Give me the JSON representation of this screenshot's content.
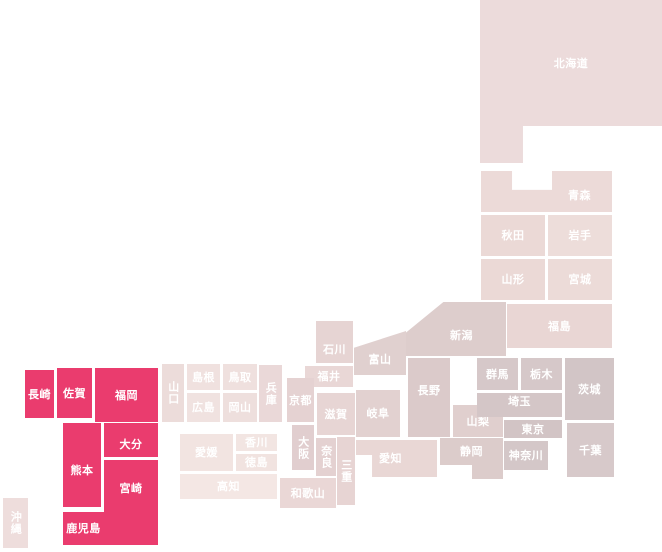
{
  "page": {
    "background": "#ffffff",
    "description_label": ""
  },
  "chart_data": {
    "type": "heatmap",
    "subtype": "japan-prefecture-tile-map",
    "title": "",
    "legend": null,
    "grid": false,
    "highlight_color": "#ea3c6e",
    "label_color": "#ffffff",
    "highlighted_prefectures": [
      "長崎",
      "佐賀",
      "福岡",
      "熊本",
      "大分",
      "宮崎",
      "鹿児島"
    ],
    "prefectures": [
      {
        "id": "hokkaido",
        "name": "北海道",
        "value": 0,
        "x": 480,
        "y": 0,
        "w": 182,
        "h": 163,
        "color": "#ecdbdb",
        "clip": "polygon(0% 0%, 100% 0%, 100% 77.3%, 23.6% 77.3%, 23.6% 100%, 0% 100%)",
        "dy": -18
      },
      {
        "id": "aomori",
        "name": "青森",
        "value": 0,
        "x": 481,
        "y": 171,
        "w": 131,
        "h": 41,
        "color": "#ecdad8",
        "clip": "polygon(0% 0%, 23.7% 0%, 23.7% 46%, 54.2% 46%, 54.2% 0%, 100% 0%, 100% 100%, 0% 100%)",
        "dx": 33,
        "dy": 4
      },
      {
        "id": "akita",
        "name": "秋田",
        "value": 0,
        "x": 481,
        "y": 215,
        "w": 64,
        "h": 41,
        "color": "#ebd9d6"
      },
      {
        "id": "iwate",
        "name": "岩手",
        "value": 0,
        "x": 548,
        "y": 215,
        "w": 64,
        "h": 41,
        "color": "#edddda"
      },
      {
        "id": "yamagata",
        "name": "山形",
        "value": 0,
        "x": 481,
        "y": 259,
        "w": 64,
        "h": 41,
        "color": "#ebd9d6"
      },
      {
        "id": "miyagi",
        "name": "宮城",
        "value": 0,
        "x": 548,
        "y": 259,
        "w": 64,
        "h": 41,
        "color": "#ecdbd8"
      },
      {
        "id": "fukushima",
        "name": "福島",
        "value": 0,
        "x": 507,
        "y": 304,
        "w": 105,
        "h": 44,
        "color": "#e9d6d4"
      },
      {
        "id": "niigata",
        "name": "新潟",
        "value": 0,
        "x": 405,
        "y": 302,
        "w": 101,
        "h": 54,
        "color": "#ddcdcc",
        "clip": "polygon(0% 58%, 38% 0%, 100% 0%, 100% 100%, 0% 100%)",
        "dx": 6,
        "dy": 6
      },
      {
        "id": "toyama",
        "name": "富山",
        "value": 0,
        "x": 354,
        "y": 331,
        "w": 52,
        "h": 44,
        "color": "#e0d0cf",
        "clip": "polygon(0% 38%, 100% 0%, 100% 100%, 0% 100%)",
        "dy": 6
      },
      {
        "id": "ishikawa",
        "name": "石川",
        "value": 0,
        "x": 316,
        "y": 321,
        "w": 37,
        "h": 42,
        "color": "#e6d4d3",
        "dy": 7
      },
      {
        "id": "fukui",
        "name": "福井",
        "value": 0,
        "x": 305,
        "y": 366,
        "w": 48,
        "h": 21,
        "color": "#e9d7d6"
      },
      {
        "id": "nagano",
        "name": "長野",
        "value": 0,
        "x": 408,
        "y": 358,
        "w": 42,
        "h": 79,
        "color": "#dbcaca",
        "dy": -7
      },
      {
        "id": "yamanashi",
        "name": "山梨",
        "value": 0,
        "x": 453,
        "y": 405,
        "w": 50,
        "h": 32,
        "color": "#e0cfce"
      },
      {
        "id": "gifu",
        "name": "岐阜",
        "value": 0,
        "x": 356,
        "y": 390,
        "w": 44,
        "h": 47,
        "color": "#e2d1d0"
      },
      {
        "id": "shizuoka",
        "name": "静岡",
        "value": 0,
        "x": 440,
        "y": 438,
        "w": 63,
        "h": 41,
        "color": "#dccccb",
        "clip": "polygon(0% 0%, 100% 0%, 100% 100%, 50.8% 100%, 50.8% 65.9%, 0% 65.9%)",
        "dy": -7
      },
      {
        "id": "aichi",
        "name": "愛知",
        "value": 0,
        "x": 356,
        "y": 440,
        "w": 81,
        "h": 37,
        "color": "#e9d7d5",
        "clip": "polygon(0% 0%, 100% 0%, 100% 100%, 19.8% 100%, 19.8% 40.5%, 0% 40.5%)",
        "dx": -6
      },
      {
        "id": "gunma",
        "name": "群馬",
        "value": 0,
        "x": 477,
        "y": 358,
        "w": 41,
        "h": 32,
        "color": "#d6c8c9"
      },
      {
        "id": "tochigi",
        "name": "栃木",
        "value": 0,
        "x": 521,
        "y": 358,
        "w": 41,
        "h": 32,
        "color": "#d6c8c9"
      },
      {
        "id": "ibaraki",
        "name": "茨城",
        "value": 0,
        "x": 565,
        "y": 358,
        "w": 49,
        "h": 62,
        "color": "#d2c5c6"
      },
      {
        "id": "saitama",
        "name": "埼玉",
        "value": 0,
        "x": 477,
        "y": 393,
        "w": 85,
        "h": 24,
        "color": "#d4c6c7",
        "dy": -4
      },
      {
        "id": "tokyo",
        "name": "東京",
        "value": 0,
        "x": 504,
        "y": 420,
        "w": 58,
        "h": 18,
        "color": "#d2c4c5"
      },
      {
        "id": "kanagawa",
        "name": "神奈川",
        "value": 0,
        "x": 504,
        "y": 441,
        "w": 44,
        "h": 29,
        "color": "#d4c7c8"
      },
      {
        "id": "chiba",
        "name": "千葉",
        "value": 0,
        "x": 567,
        "y": 423,
        "w": 47,
        "h": 54,
        "color": "#d7c9ca"
      },
      {
        "id": "shiga",
        "name": "滋賀",
        "value": 0,
        "x": 317,
        "y": 393,
        "w": 38,
        "h": 42,
        "color": "#e7d5d4"
      },
      {
        "id": "kyoto",
        "name": "京都",
        "value": 0,
        "x": 287,
        "y": 378,
        "w": 27,
        "h": 44,
        "color": "#e5d2d2"
      },
      {
        "id": "osaka",
        "name": "大阪",
        "value": 0,
        "x": 292,
        "y": 425,
        "w": 22,
        "h": 45,
        "color": "#e1cecf",
        "dir": "v"
      },
      {
        "id": "nara",
        "name": "奈良",
        "value": 0,
        "x": 316,
        "y": 438,
        "w": 20,
        "h": 38,
        "color": "#e4d1d1",
        "dir": "v"
      },
      {
        "id": "mie",
        "name": "三重",
        "value": 0,
        "x": 337,
        "y": 437,
        "w": 18,
        "h": 68,
        "color": "#e7d4d3",
        "dir": "v"
      },
      {
        "id": "wakayama",
        "name": "和歌山",
        "value": 0,
        "x": 280,
        "y": 478,
        "w": 56,
        "h": 30,
        "color": "#ead7d6"
      },
      {
        "id": "hyogo",
        "name": "兵庫",
        "value": 0,
        "x": 259,
        "y": 365,
        "w": 23,
        "h": 57,
        "color": "#ead8d8",
        "dir": "v"
      },
      {
        "id": "tottori",
        "name": "鳥取",
        "value": 0,
        "x": 223,
        "y": 364,
        "w": 34,
        "h": 26,
        "color": "#efe0de"
      },
      {
        "id": "shimane",
        "name": "島根",
        "value": 0,
        "x": 187,
        "y": 364,
        "w": 33,
        "h": 26,
        "color": "#f0e1df"
      },
      {
        "id": "okayama",
        "name": "岡山",
        "value": 0,
        "x": 223,
        "y": 393,
        "w": 34,
        "h": 29,
        "color": "#eedfdd"
      },
      {
        "id": "hiroshima",
        "name": "広島",
        "value": 0,
        "x": 187,
        "y": 393,
        "w": 33,
        "h": 29,
        "color": "#f0e2e0"
      },
      {
        "id": "yamaguchi",
        "name": "山口",
        "value": 0,
        "x": 162,
        "y": 364,
        "w": 22,
        "h": 58,
        "color": "#ecdcda",
        "dir": "v"
      },
      {
        "id": "kagawa",
        "name": "香川",
        "value": 0,
        "x": 236,
        "y": 434,
        "w": 41,
        "h": 17,
        "color": "#f2e5e2"
      },
      {
        "id": "ehime",
        "name": "愛媛",
        "value": 0,
        "x": 180,
        "y": 434,
        "w": 53,
        "h": 37,
        "color": "#f2e4e1"
      },
      {
        "id": "tokushima",
        "name": "徳島",
        "value": 0,
        "x": 236,
        "y": 454,
        "w": 41,
        "h": 17,
        "color": "#f1e3e0"
      },
      {
        "id": "kochi",
        "name": "高知",
        "value": 0,
        "x": 180,
        "y": 474,
        "w": 97,
        "h": 25,
        "color": "#f4e7e4"
      },
      {
        "id": "fukuoka",
        "name": "福岡",
        "value": 1,
        "x": 95,
        "y": 368,
        "w": 63,
        "h": 54,
        "color": "#ea3c6e"
      },
      {
        "id": "saga",
        "name": "佐賀",
        "value": 1,
        "x": 57,
        "y": 368,
        "w": 35,
        "h": 50,
        "color": "#ea3c6e"
      },
      {
        "id": "nagasaki",
        "name": "長崎",
        "value": 1,
        "x": 25,
        "y": 370,
        "w": 29,
        "h": 48,
        "color": "#ea3c6e"
      },
      {
        "id": "kumamoto",
        "name": "熊本",
        "value": 1,
        "x": 63,
        "y": 423,
        "w": 38,
        "h": 84,
        "color": "#ea3c6e",
        "dy": 5
      },
      {
        "id": "oita",
        "name": "大分",
        "value": 1,
        "x": 104,
        "y": 423,
        "w": 54,
        "h": 34,
        "color": "#ea3c6e",
        "dy": 4
      },
      {
        "id": "miyazaki",
        "name": "宮崎",
        "value": 1,
        "x": 104,
        "y": 460,
        "w": 54,
        "h": 57,
        "color": "#ea3c6e"
      },
      {
        "id": "kagoshima",
        "name": "鹿児島",
        "value": 1,
        "x": 63,
        "y": 512,
        "w": 95,
        "h": 33,
        "color": "#ea3c6e",
        "dx": -27
      },
      {
        "id": "okinawa",
        "name": "沖縄",
        "value": 0,
        "x": 3,
        "y": 498,
        "w": 25,
        "h": 50,
        "color": "#eedddc",
        "dir": "v"
      }
    ]
  }
}
